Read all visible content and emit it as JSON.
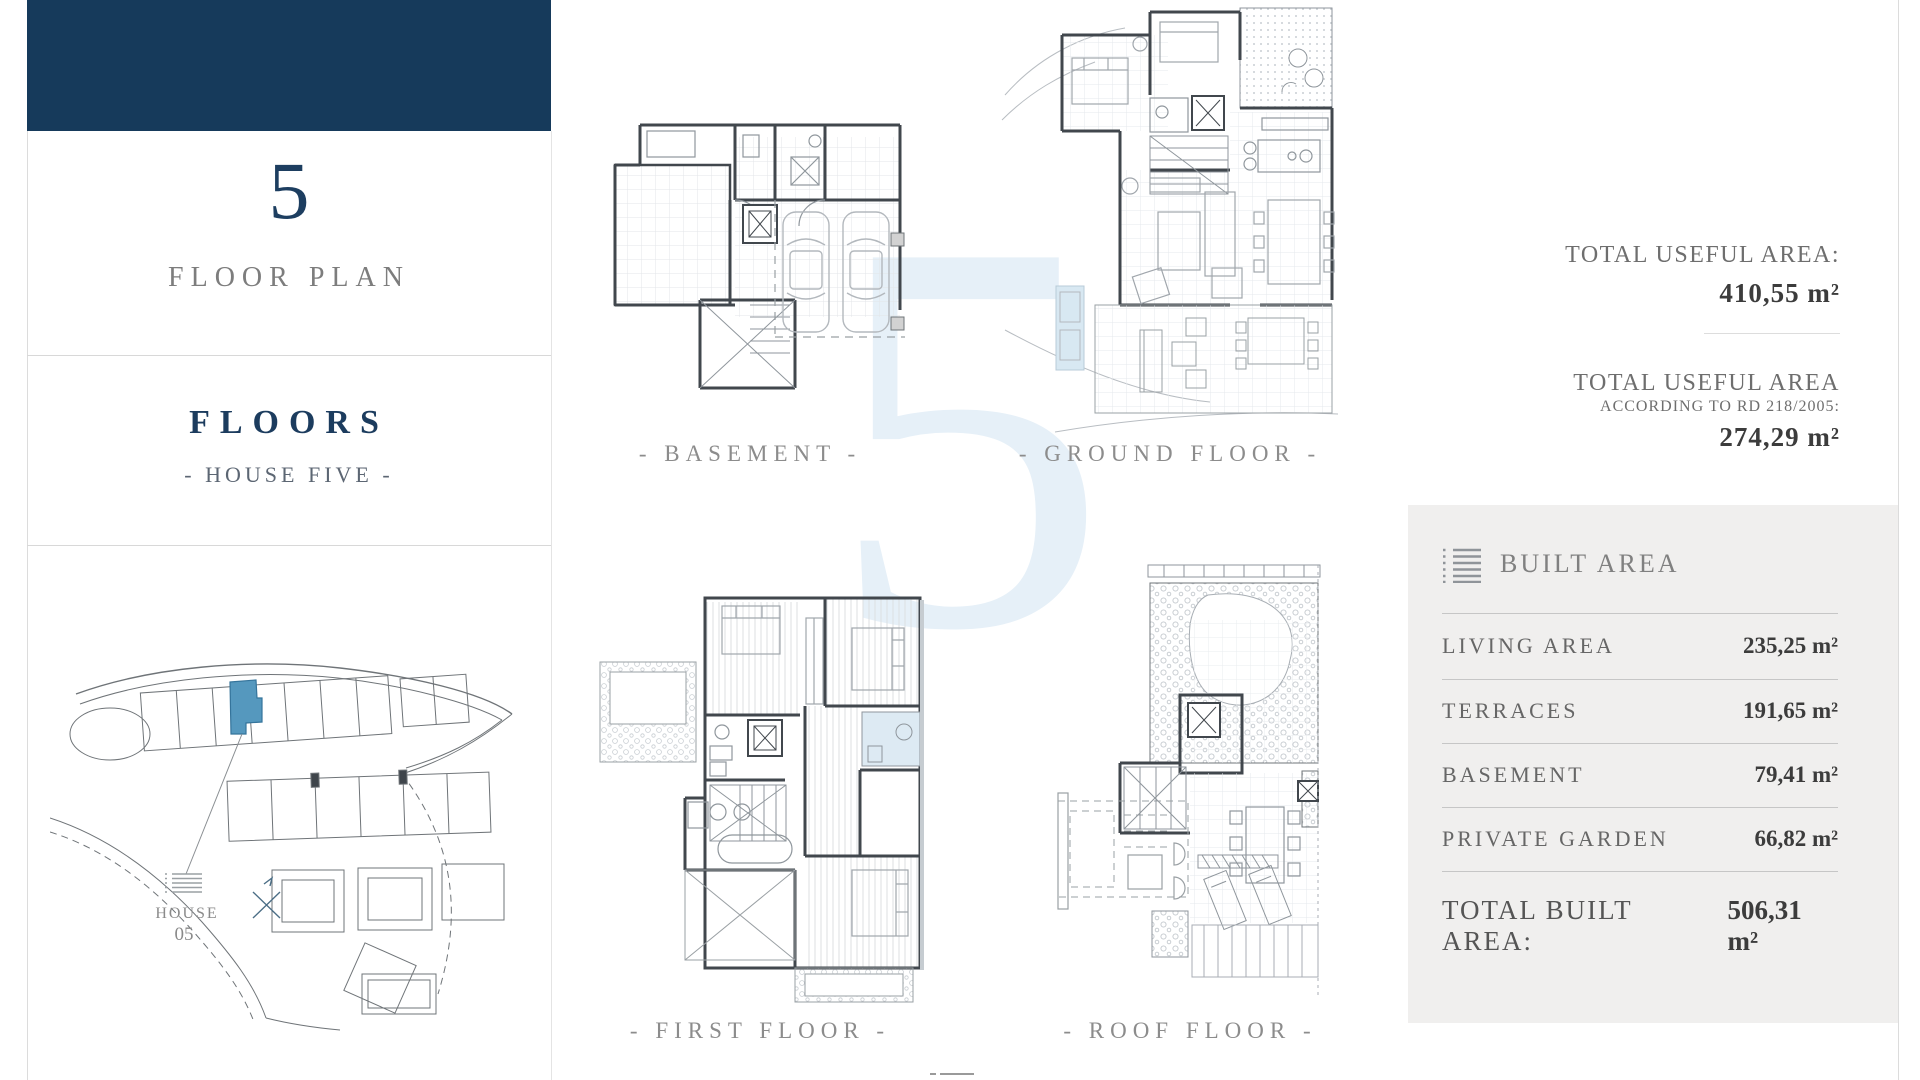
{
  "page": {
    "watermark_digit": "5",
    "accent_color": "#163a5b",
    "highlight_color": "#5598be",
    "watermark_color": "#e6f0f8"
  },
  "sidebar": {
    "number": "5",
    "subtitle": "FLOOR PLAN",
    "section_title": "FLOORS",
    "section_subtitle": "- HOUSE FIVE -",
    "siteplan": {
      "house_label": "HOUSE",
      "house_number": "05"
    }
  },
  "plans": [
    {
      "label": "- BASEMENT -"
    },
    {
      "label": "- GROUND FLOOR -"
    },
    {
      "label": "- FIRST FLOOR -"
    },
    {
      "label": "- ROOF FLOOR -"
    }
  ],
  "stats": {
    "useful_area_label": "TOTAL USEFUL AREA:",
    "useful_area_value": "410,55 m²",
    "useful_area_rd_label": "TOTAL USEFUL AREA",
    "useful_area_rd_sublabel": "ACCORDING TO RD 218/2005:",
    "useful_area_rd_value": "274,29 m²"
  },
  "built_area": {
    "title": "BUILT AREA",
    "rows": [
      {
        "label": "LIVING AREA",
        "value": "235,25 m²"
      },
      {
        "label": "TERRACES",
        "value": "191,65 m²"
      },
      {
        "label": "BASEMENT",
        "value": "79,41 m²"
      },
      {
        "label": "PRIVATE GARDEN",
        "value": "66,82 m²"
      }
    ],
    "total_label": "TOTAL BUILT AREA:",
    "total_value": "506,31 m²"
  }
}
